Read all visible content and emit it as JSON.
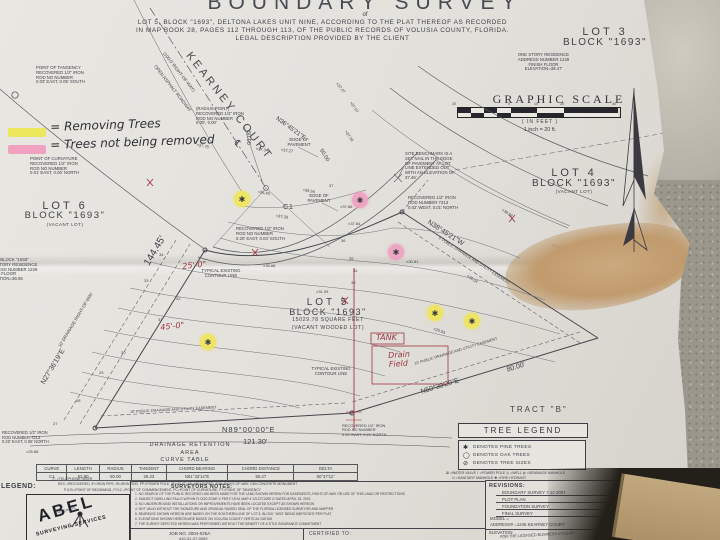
{
  "colors": {
    "highlight_yellow": "#ede75e",
    "highlight_pink": "#f2a2c1",
    "annotation_red": "#9c3540",
    "stain_tan": "#c19b6d"
  },
  "title_block": {
    "title": "BOUNDARY SURVEY",
    "subtitle": "of",
    "line1": "LOT 5, BLOCK \"1693\", DELTONA LAKES UNIT NINE, ACCORDING TO THE PLAT THEREOF AS RECORDED",
    "line2": "IN MAP BOOK 28, PAGES 112 THROUGH 113, OF THE PUBLIC RECORDS OF VOLUSIA COUNTY, FLORIDA.",
    "line3": "LEGAL DESCRIPTION PROVIDED BY THE CLIENT"
  },
  "tree_key": {
    "yellow_label": "= Removing Trees",
    "pink_label": "= Trees not being removed"
  },
  "street": {
    "name": "KEARNEY COURT",
    "centerline_symbol": "℄",
    "row": "(100.0' RIGHT-OF-WAY)",
    "surface": "OPEN ASPHALT ROADWAY"
  },
  "monuments": {
    "tangency": "POINT OF TANGENCY\nRECOVERED 1/2\" IRON\nROD NO NUMBER\n0.03' EAST, 0.05' SOUTH",
    "curvature": "POINT OF CURVATURE\nRECOVERED 1/2\" IRON\nROD NO NUMBER\n0.01' EAST, 0.06' NORTH",
    "radius_point": "(RADIUS POINT)\nRECOVERED 1/2\" IRON\nROD NO NUMBER\n0.00', 0.00'",
    "benchmark": "SITE BENCHMARK IS A\nSET NAIL IN THE EDGE\nOF PAVEMENT AT LOT\nLINE EXTENDED OUT\nWITH AN ELEVATION OF\n37.46'",
    "rod_7213_ne": "RECOVERED 1/2\" IRON\nROD NUMBER 7213\n0.02' WEST, 0.01' NORTH",
    "rod_no_number": "RECOVERED 1/2\" IRON\nROD NO NUMBER\n0.20' EAST, 0.04' SOUTH",
    "rod_7213_sw": "RECOVERED 1/2\" IRON\nROD NUMBER 7213\n0.20' EAST, 0.05' NORTH",
    "rod_se": "RECOVERED 1/2\" IRON\nROD NO NUMBER\n0.05' EAST, 0.21' NORTH"
  },
  "lots": {
    "lot3": {
      "name": "LOT 3",
      "block": "BLOCK \"1693\"",
      "note": "ONE STORY RESIDENCE\nADDRESS NUMBER 1249\nFINISH FLOOR\nELEVATION=39.47'"
    },
    "lot4": {
      "name": "LOT 4",
      "block": "BLOCK \"1693\"",
      "status": "(VACANT LOT)"
    },
    "lot5": {
      "name": "LOT 5",
      "block": "BLOCK \"1693\"",
      "area": "15029.78 SQUARE FEET",
      "status": "(VACANT WOODED LOT)"
    },
    "lot6": {
      "name": "LOT 6",
      "block": "BLOCK \"1693\"",
      "status": "(VACANT LOT)"
    },
    "lot7": {
      "note": "LOT 7, BLOCK \"1693\"\nONE STORY RESIDENCE\nADDRESS NUMBER 1239\nFINISH FLOOR\nELEVATION=38.95"
    }
  },
  "graphic_scale": {
    "title": "GRAPHIC SCALE",
    "ticks": [
      "20",
      "0",
      "10",
      "20",
      "40"
    ],
    "units": "( IN FEET )",
    "ratio": "1 inch =   20 ft."
  },
  "bearings": {
    "north_arc": "N36°45'21\"E",
    "east_line": "N38°45'21\"W",
    "east_dist": "105.00'",
    "east_esmt": "6' PUBLIC DRAINAGE AND UTILITY EASEMENT",
    "west_line": "N27°36'19\"E",
    "west_dist": "144.45'",
    "west_row": "10' DRAINAGE RIGHT-OF-WAY",
    "south_line": "N89°00'00\"E",
    "south_dist": "121.30'",
    "south_esmt": "10' PUBLIC DRAINAGE AND UTILITY EASEMENT",
    "se_line": "N50°30'29\"E",
    "se_dist": "80.00'",
    "se_esmt": "10' PUBLIC DRAINAGE AND UTILITY EASEMENT"
  },
  "labels": {
    "c1": "C1",
    "edge_of_pavement": "EDGE OF\nPAVEMENT",
    "tract_b": "TRACT  \"B\"",
    "drainage_area1": "DRAINAGE  RETENTION",
    "drainage_area2": "AREA",
    "contour_note": "TYPICAL EXISTING\nCONTOUR LINE"
  },
  "handwritten": {
    "tank": "TANK",
    "drain_field": "Drain\nField",
    "dim_a": "25'-0\"",
    "dim_b": "45'-0\""
  },
  "spots": [
    "×37.78",
    "×37.34",
    "×37.27",
    "×37.67",
    "×37.56",
    "×37.47",
    "×36.45",
    "×36.56",
    "×37.39",
    "×37.66",
    "×37.64",
    "×35.68",
    "×30.64",
    "×30.81",
    "×30.54",
    "×31.09",
    "×26.53",
    "×25.88",
    "×23.86"
  ],
  "arc_dims": [
    "50.00",
    "50.00"
  ],
  "contour_labels": [
    "37",
    "36",
    "35",
    "34",
    "33",
    "32",
    "31",
    "30",
    "29",
    "28",
    "27"
  ],
  "curve_table": {
    "title": "CURVE TABLE",
    "headers": [
      "CURVE",
      "LENGTH",
      "RADIUS",
      "TANGENT",
      "CHORD BEARING",
      "CHORD DISTANCE",
      "DELTA"
    ],
    "rows": [
      [
        "C1",
        "52.90",
        "50.00",
        "29.23",
        "N81°33'14\"E",
        "50.47",
        "60°37'11\""
      ]
    ]
  },
  "tree_legend": {
    "title": "TREE  LEGEND",
    "items": [
      {
        "icon": "pine-tree-symbol",
        "symbol": "✱",
        "label": "DENOTES PINE TREES"
      },
      {
        "icon": "oak-tree-symbol",
        "symbol": "◯",
        "label": "DENOTES OAK TREES"
      },
      {
        "icon": "tree-size-symbol",
        "symbol": "⊘",
        "label": "DENOTES TREE SIZES"
      }
    ]
  },
  "footer": {
    "legend_label": "LEGEND:",
    "telephone": "Ⓣ =TELEPHONE RISER",
    "abbrev1": "REC.=RECOVERED, IP=IRON PIPE, IR=IRON ROD, PP=POWER POLE, (P)=PLAT, (M)=MEASURED, R/W=RIGHT-OF-WAY, CM=CONCRETE MONUMENT",
    "abbrev2": "P.O.B.=POINT OF BEGINNING, P.O.C.=POINT OF COMMENCEMENT, PC=POINT OF CURVATURE, PT=POINT OF TANGENCY",
    "utilities1": "⊠ =WATER VALVE   ⌇ =POWER POLE   ◎ =WELL   ◍ =DRAINAGE MANHOLE",
    "utilities2": "⊙ =SANITARY MANHOLE   ✚ =FIRE HYDRANT",
    "company": {
      "name": "ABEL",
      "tagline": "SURVEYING SERVICES",
      "location": "DELTONA, FL."
    },
    "notes_title": "SURVEYORS NOTES:",
    "notes": [
      "1. NO SEARCH OF THE PUBLIC RECORDS HAS BEEN MADE FOR THE LAND SHOWN HEREIN FOR EASEMENTS, RIGHT-OF-WAY OR USE OF THIS LAND OR RESTRICTIONS",
      "2. SUBJECT DWELLING FALLS WITHIN FLOOD ZONE X PER F.I.R.M. MAP # 12127C0290 G DATED APRIL 15, 2002",
      "3. NO UNDERGROUND INSTALLATIONS OR IMPROVEMENTS HAVE BEEN LOCATED EXCEPT AS SHOWN HEREON",
      "4. NOT VALID WITHOUT THE SIGNATURE AND ORIGINAL RAISED SEAL OF THE FLORIDA LICENSED SURVEYOR AND MAPPER",
      "5. BEARINGS SHOWN HEREON ARE BASED ON THE SOUTHERN LINE OF LOT 5, BLOCK \"1693\" BEING N89°00'00\"E PER PLAT",
      "6. ELEVATIONS SHOWN HEREON ARE BASED ON VOLUSIA COUNTY VERTICAL DATUM",
      "7. THE SURVEY DEPICTED HEREIN WAS PERFORMED WITHOUT THE BENEFIT OF A TITLE INSURANCE COMMITMENT"
    ],
    "job_no": "JOB NO.   2004-025A",
    "parcel": "#10-31-07-0050",
    "certified_to": "CERTIFIED  TO:",
    "revisions_title": "REVISIONS:",
    "revisions": [
      "BOUNDARY SURVEY 7-12-2007",
      "PLOT PLAN",
      "FOUNDATION SURVEY",
      "FINAL SURVEY"
    ],
    "model": "MODEL =",
    "address": "ADDRESS# =1246 KEARNEY COURT",
    "elevation": "ELEVATION",
    "licensed": "FOR THE LICENSED BUSINESS #7018 BY:"
  }
}
